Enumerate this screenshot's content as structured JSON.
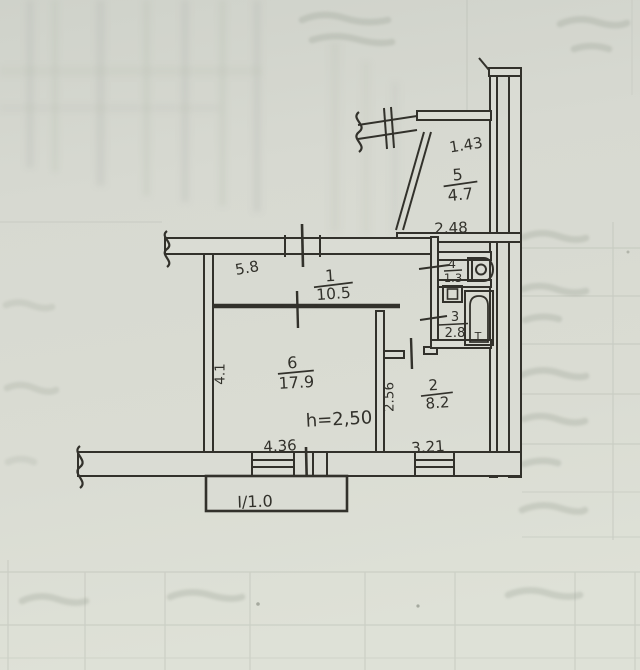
{
  "floor_plan": {
    "rooms": {
      "r1": {
        "number": "1",
        "area": "10.5"
      },
      "r2": {
        "number": "2",
        "area": "8.2"
      },
      "r3": {
        "number": "3",
        "area": "2.8"
      },
      "r4": {
        "number": "4",
        "area": "1.3"
      },
      "r5": {
        "number": "5",
        "area": "4.7"
      },
      "r6": {
        "number": "6",
        "area": "17.9"
      }
    },
    "dimensions": {
      "balcony_width": "1.43",
      "balcony_length": "2.48",
      "top_wall": "5.8",
      "left_wall": "4.1",
      "room2_side": "2.56",
      "room6_bottom": "4.36",
      "room2_bottom": "3.21"
    },
    "notes": {
      "ceiling_height": "h=2,50",
      "loggia": "I/1.0",
      "faucet_mark": "T"
    },
    "colors": {
      "paper": "#d8dad2",
      "ink": "#32312b",
      "bleed": "#9aa194"
    }
  }
}
